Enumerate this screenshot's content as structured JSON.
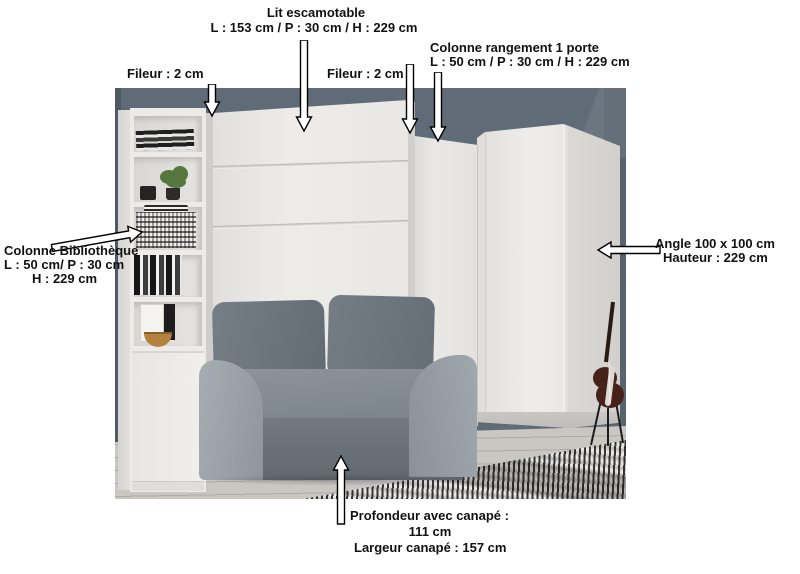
{
  "annotations": {
    "lit": {
      "title": "Lit escamotable",
      "dims": "L : 153 cm / P : 30 cm / H : 229 cm"
    },
    "fileur_left": "Fileur : 2 cm",
    "fileur_right": "Fileur : 2 cm",
    "colonne_rangement": {
      "title": "Colonne rangement 1 porte",
      "dims": "L : 50 cm / P : 30 cm / H : 229 cm"
    },
    "colonne_bibliotheque": {
      "title": "Colonne Bibliothèque",
      "dims1": "L : 50 cm/ P : 30 cm",
      "dims2": "H : 229 cm"
    },
    "angle": {
      "title": "Angle 100 x 100 cm",
      "dims": "Hauteur : 229 cm"
    },
    "canape": {
      "depth_label": "Profondeur avec canapé :",
      "depth_value": "111 cm",
      "width_label": "Largeur canapé : 157 cm"
    }
  },
  "colors": {
    "annotation_text": "#111111",
    "wall": "#5f6b76",
    "furniture_white": "#eae8e5",
    "sofa_dark": "#666e75",
    "sofa_mid": "#838b92",
    "sofa_light": "#9aa2a8",
    "floor": "#cac7c2",
    "rug_dark": "#1c1c1c",
    "rug_light": "#e6e4e0"
  }
}
